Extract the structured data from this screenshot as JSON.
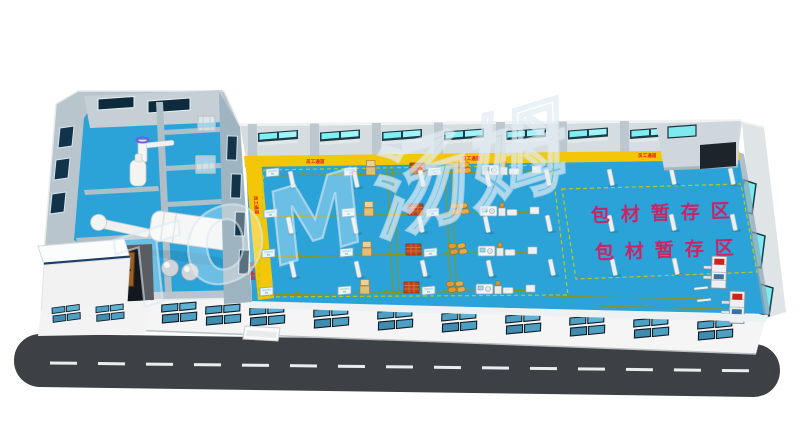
{
  "scene": {
    "watermark_text": "TOM汤姆",
    "storage_zone_label_line1": "包材暂存区",
    "storage_zone_label_line2": "包材暂存区",
    "walkway_label": "员工通道",
    "colors": {
      "floor_blue": "#2ba3d9",
      "walkway_yellow": "#f3c608",
      "walkway_label_red": "#e31c1c",
      "storage_label_magenta": "#cb2368",
      "road_asphalt": "#3d4044",
      "road_line_white": "#f5f6f7",
      "back_wall_gray": "#d6dde1",
      "side_wall_gray": "#9fb4c1",
      "facade_white": "#f4f5f4",
      "window_glass_teal": "#7fe9f0",
      "window_frame_dark": "#15303f",
      "facade_glass_blue": "#4e9fc4",
      "area_outline_green": "#b8cc12",
      "conveyor_olive": "#8c9416",
      "crate_red": "#b7491d",
      "box_tan": "#e3bd7a",
      "sack_orange": "#e6972e",
      "machine_white": "#f3f6f7",
      "watermark_white": "#ffffff"
    }
  }
}
